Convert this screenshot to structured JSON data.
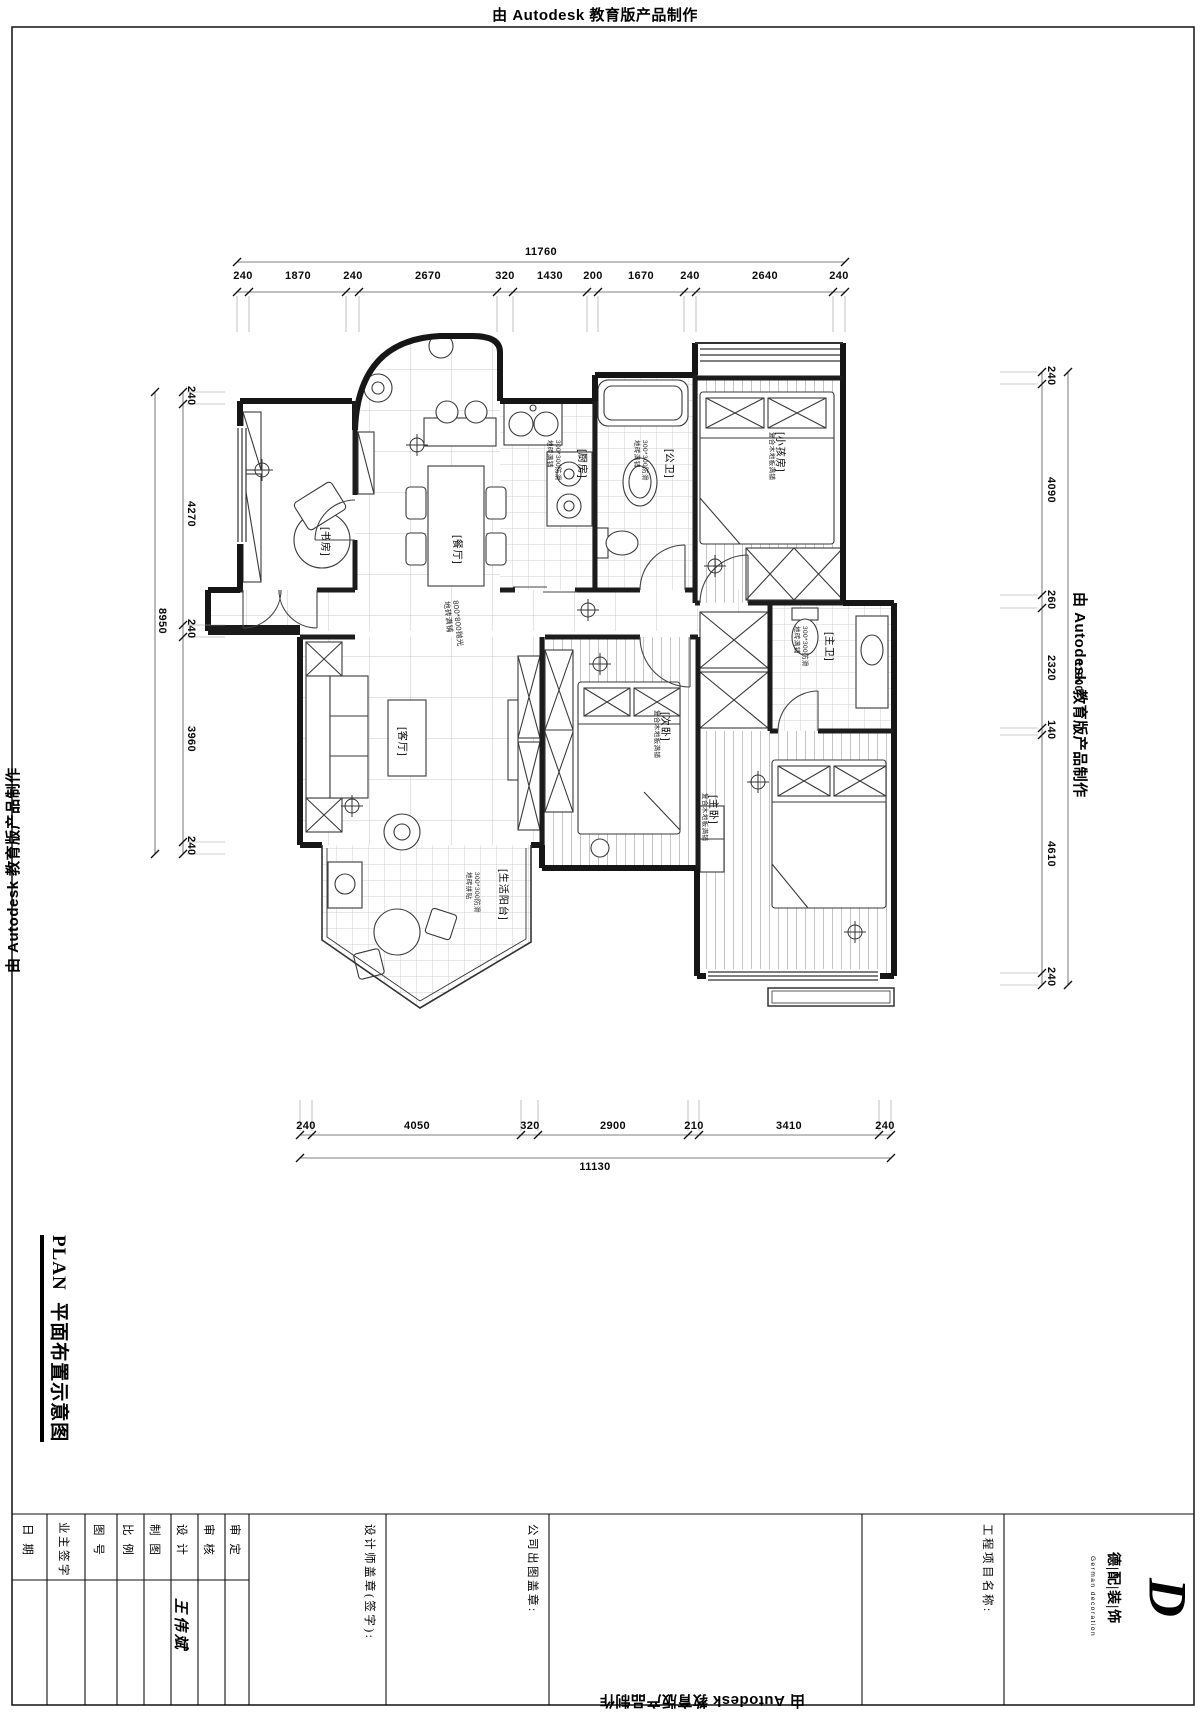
{
  "stamp": "由 Autodesk 教育版产品制作",
  "dimensions": {
    "top": {
      "total": "11760",
      "segments": [
        "240",
        "1870",
        "240",
        "2670",
        "320",
        "1430",
        "200",
        "1670",
        "240",
        "2640",
        "240"
      ]
    },
    "bottom": {
      "total": "11130",
      "segments": [
        "240",
        "4050",
        "320",
        "2900",
        "210",
        "3410",
        "240"
      ]
    },
    "left": {
      "total": "8950",
      "segments": [
        "240",
        "4270",
        "240",
        "3960",
        "240"
      ]
    },
    "right": {
      "total": "11900",
      "segments": [
        "240",
        "4090",
        "260",
        "2320",
        "140",
        "4610",
        "240"
      ]
    }
  },
  "rooms": {
    "study": {
      "label": "[书房]"
    },
    "dining": {
      "label": "[餐厅]"
    },
    "kitchen": {
      "label": "[厨房]",
      "floor_line1": "300*300防滑",
      "floor_line2": "地砖满铺"
    },
    "public_bath": {
      "label": "[公卫]",
      "floor_line1": "300*300防滑",
      "floor_line2": "地砖满铺"
    },
    "kids": {
      "label": "[小孩房]",
      "floor": "复合木地板满铺"
    },
    "living": {
      "label": "[客厅]"
    },
    "second_bed": {
      "label": "[次卧]",
      "floor": "复合木地板满铺"
    },
    "master_bed": {
      "label": "[主卧]",
      "floor": "复合木地板满铺"
    },
    "master_bath": {
      "label": "[主卫]",
      "floor_line1": "300*300防滑",
      "floor_line2": "地砖满铺"
    },
    "balcony": {
      "label": "[生活阳台]",
      "floor_line1": "300*300防滑",
      "floor_line2": "地砖拼贴"
    },
    "corridor": {
      "floor_line1": "800*800抛光",
      "floor_line2": "地砖满铺"
    }
  },
  "title": {
    "plan": "PLAN  平面布置示意图",
    "scale_label": "SCALE",
    "scale_value": "1:50"
  },
  "titleblock": {
    "approved": "审 定",
    "reviewed": "审 核",
    "designed": "设 计",
    "drafted": "制 图",
    "scale": "比 例",
    "drawing_no": "图 号",
    "owner_sign": "业主签字",
    "date": "日 期",
    "designer_name": "王伟斌",
    "designer_stamp": "设计师盖章(签字):",
    "company_stamp": "公司出图盖章:",
    "project_name": "工程项目名称:",
    "logo_name": "德|配|装|饰",
    "logo_tagline": "German decoration",
    "logo_mark": "D"
  }
}
